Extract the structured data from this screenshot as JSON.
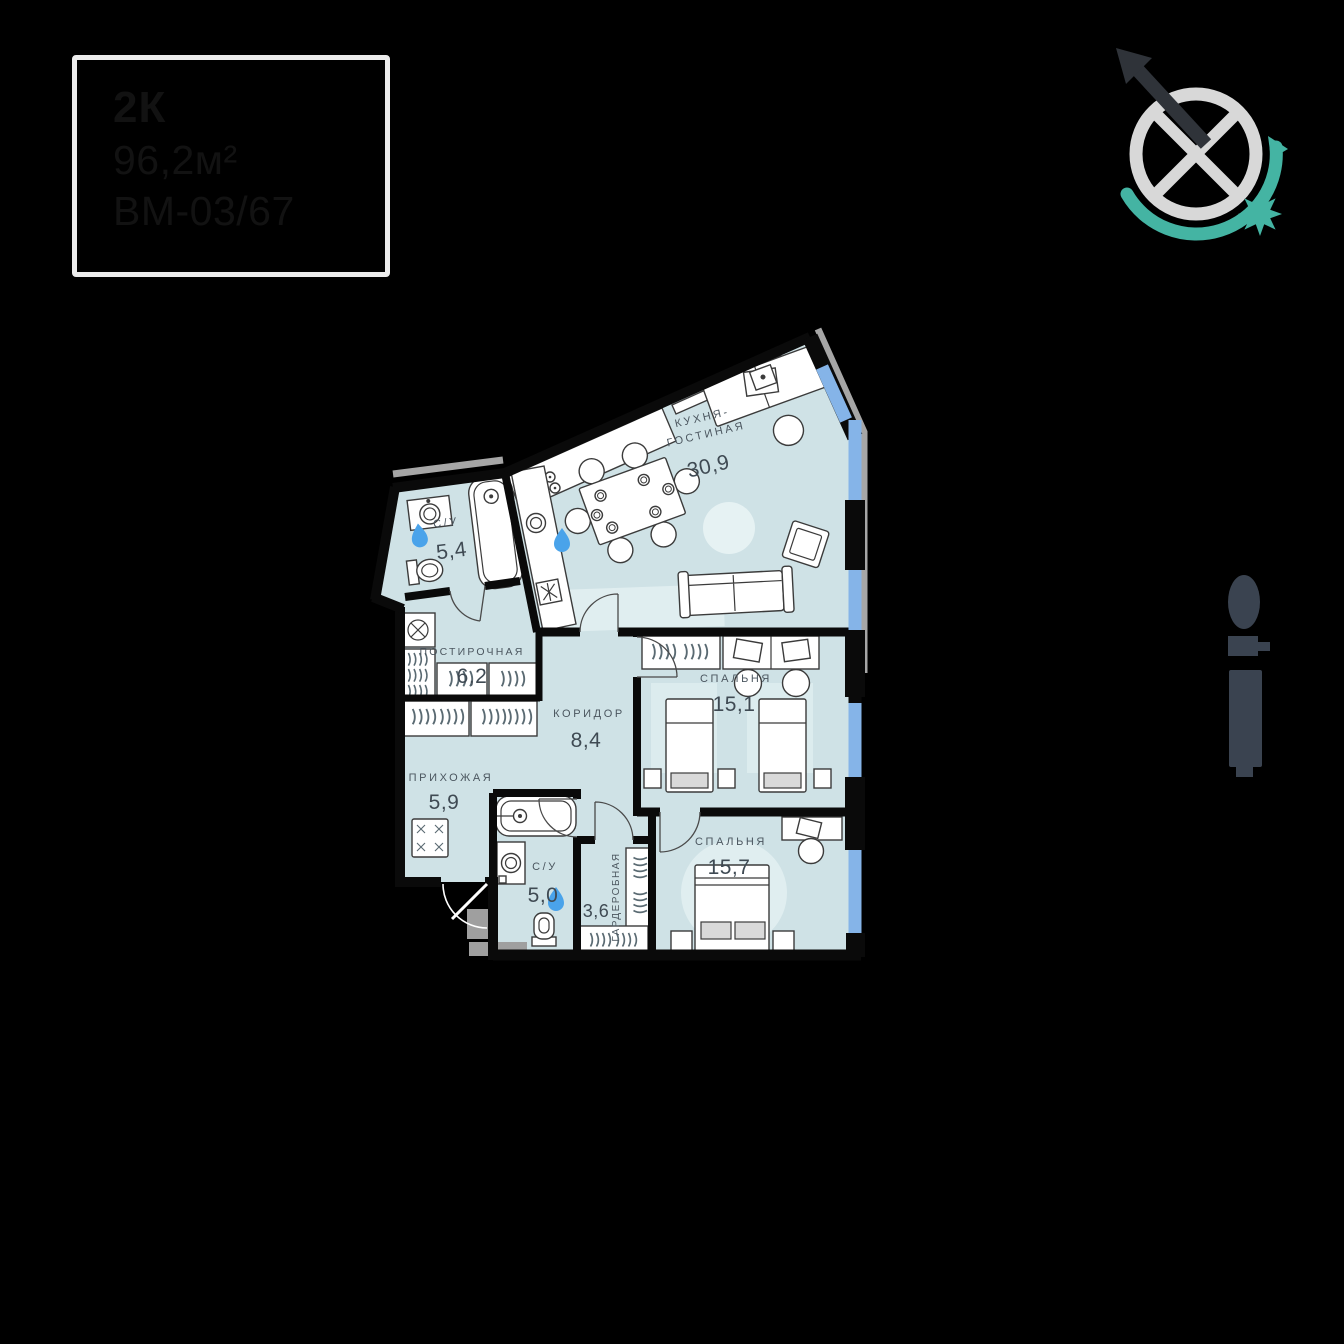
{
  "badge": {
    "rooms_type": "2К",
    "total_area": "96,2м²",
    "unit_code": "ВМ-03/67"
  },
  "rooms": [
    {
      "id": "kitchen-living",
      "name": "КУХНЯ-ГОСТИНАЯ",
      "name_line1": "КУХНЯ-",
      "name_line2": "ГОСТИНАЯ",
      "area": "30,9"
    },
    {
      "id": "bathroom-1",
      "name": "С/У",
      "area": "5,4"
    },
    {
      "id": "laundry",
      "name": "ПОСТИРОЧНАЯ",
      "area": "6,2"
    },
    {
      "id": "corridor",
      "name": "КОРИДОР",
      "area": "8,4"
    },
    {
      "id": "hallway",
      "name": "ПРИХОЖАЯ",
      "area": "5,9"
    },
    {
      "id": "bedroom-1",
      "name": "СПАЛЬНЯ",
      "area": "15,1"
    },
    {
      "id": "bathroom-2",
      "name": "С/У",
      "area": "5,0"
    },
    {
      "id": "wardrobe",
      "name": "ГАРДЕРОБНАЯ",
      "area": "3,6"
    },
    {
      "id": "bedroom-2",
      "name": "СПАЛЬНЯ",
      "area": "15,7"
    }
  ],
  "icons": {
    "compass": "compass-needle-with-sun-icon",
    "building": "building-position-indicator",
    "water_drop": "water-drop-icon"
  },
  "colors": {
    "background": "#000000",
    "room_fill": "#cfe2e6",
    "room_fill_light": "#e0eef0",
    "wall": "#0a0a0a",
    "window_blue": "#85b4e8",
    "facade_gray": "#a6a6a6",
    "teal_accent": "#44b4a3",
    "compass_gray": "#d8d8d8",
    "needle_dark": "#2f3339",
    "water_drop_blue": "#4aa3ea",
    "label_text": "#4b565f",
    "indicator_dark": "#3a4350",
    "badge_border": "#ececec",
    "badge_text": "#121212"
  }
}
